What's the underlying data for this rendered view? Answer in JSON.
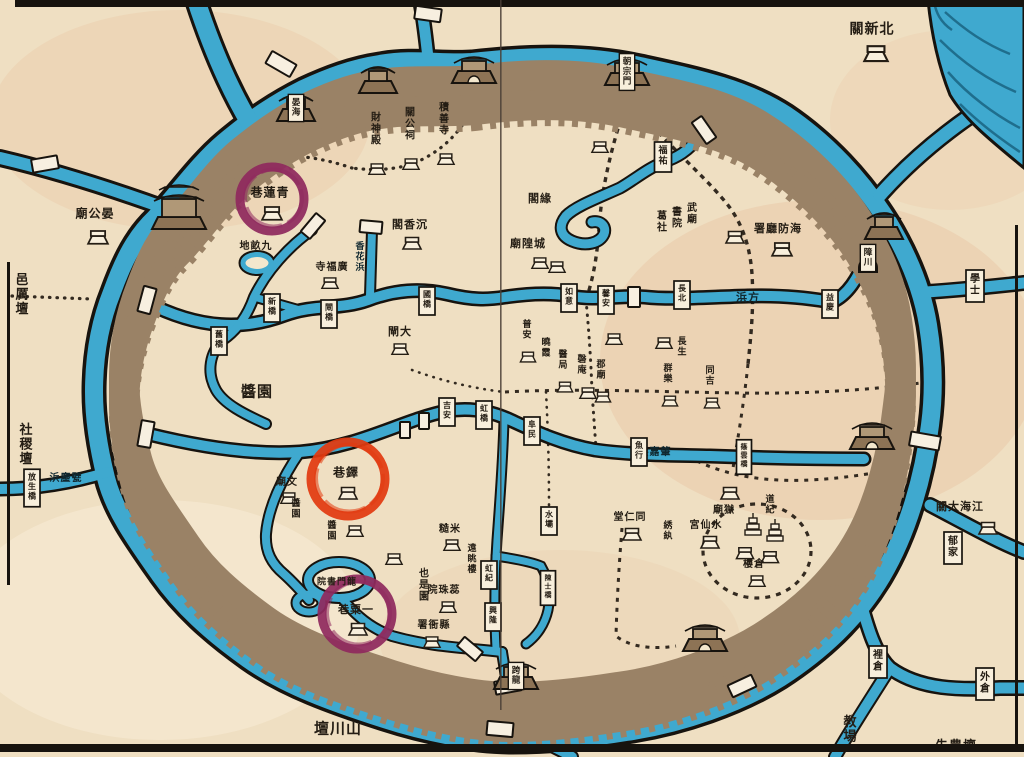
{
  "palette": {
    "paper": "#efdfc2",
    "paper_light": "#f6ead2",
    "tint_pink": "#e4b28c",
    "water": "#3fa9cf",
    "water_dark": "#2383a8",
    "ink": "#241d14",
    "wall": "#9b capitalize",
    "wall_band": "#9a8266",
    "wall_line": "#64503a",
    "box_fill": "#f8efdc",
    "purple": "#8f2a5e",
    "red": "#e23a10"
  },
  "annotation_circles": [
    {
      "id": "circle-qinglian",
      "cx": 272,
      "cy": 199,
      "r": 32,
      "color": "#8f2a5e",
      "label": "青蓮巷"
    },
    {
      "id": "circle-duo",
      "cx": 348,
      "cy": 479,
      "r": 37,
      "color": "#e23a10",
      "label": "鐸巷"
    },
    {
      "id": "circle-yisu",
      "cx": 357,
      "cy": 614,
      "r": 35,
      "color": "#8f2a5e",
      "label": "一粟巷"
    }
  ],
  "labels": [
    {
      "t": "關新北",
      "x": 872,
      "y": 28,
      "o": "h",
      "s": 14,
      "house": {
        "x": 876,
        "y": 52,
        "k": 1.3
      }
    },
    {
      "t": "廟公晏",
      "x": 95,
      "y": 213,
      "o": "h",
      "s": 12,
      "house": {
        "x": 98,
        "y": 236,
        "k": 1.1
      }
    },
    {
      "t": "邑厲壇",
      "x": 22,
      "y": 295,
      "o": "v",
      "s": 13
    },
    {
      "t": "社稷壇",
      "x": 26,
      "y": 445,
      "o": "v",
      "s": 13
    },
    {
      "t": "壇川山",
      "x": 338,
      "y": 728,
      "o": "h",
      "s": 15
    },
    {
      "t": "教場",
      "x": 850,
      "y": 730,
      "o": "v",
      "s": 13
    },
    {
      "t": "先農壇",
      "x": 956,
      "y": 745,
      "o": "h",
      "s": 13
    },
    {
      "t": "署廳防海",
      "x": 778,
      "y": 228,
      "o": "h",
      "s": 11,
      "house": {
        "x": 782,
        "y": 248,
        "k": 1.1
      }
    },
    {
      "t": "浜方",
      "x": 748,
      "y": 297,
      "o": "h",
      "s": 11,
      "cls": "oncanal"
    },
    {
      "t": "浜嘉肇",
      "x": 655,
      "y": 451,
      "o": "h",
      "s": 10,
      "cls": "oncanal"
    },
    {
      "t": "浜麈甓",
      "x": 66,
      "y": 477,
      "o": "h",
      "s": 10,
      "cls": "oncanal"
    },
    {
      "t": "學士",
      "x": 975,
      "y": 286,
      "o": "v",
      "s": 10,
      "box": true
    },
    {
      "t": "郁家",
      "x": 953,
      "y": 548,
      "o": "v",
      "s": 10,
      "box": true
    },
    {
      "t": "裡倉",
      "x": 878,
      "y": 662,
      "o": "v",
      "s": 10,
      "box": true
    },
    {
      "t": "外倉",
      "x": 985,
      "y": 684,
      "o": "v",
      "s": 10,
      "box": true
    },
    {
      "t": "關大海江",
      "x": 960,
      "y": 506,
      "o": "h",
      "s": 11,
      "house": {
        "x": 988,
        "y": 527,
        "k": 1
      }
    },
    {
      "t": "放生橋",
      "x": 32,
      "y": 488,
      "o": "v",
      "s": 8,
      "box": true
    },
    {
      "t": "巷蓮青",
      "x": 270,
      "y": 192,
      "o": "h",
      "s": 12,
      "house": {
        "x": 272,
        "y": 212,
        "k": 1.1
      }
    },
    {
      "t": "地畝九",
      "x": 256,
      "y": 245,
      "o": "h",
      "s": 10
    },
    {
      "t": "寺福廣",
      "x": 332,
      "y": 266,
      "o": "h",
      "s": 10,
      "house": {
        "x": 330,
        "y": 282,
        "k": 0.9
      }
    },
    {
      "t": "香花浜",
      "x": 360,
      "y": 258,
      "o": "v",
      "s": 9,
      "cls": "oncanal"
    },
    {
      "t": "財神殿",
      "x": 376,
      "y": 130,
      "o": "v",
      "s": 10,
      "house": {
        "x": 377,
        "y": 168,
        "k": 0.9
      }
    },
    {
      "t": "關公祠",
      "x": 410,
      "y": 125,
      "o": "v",
      "s": 10,
      "house": {
        "x": 411,
        "y": 163,
        "k": 0.9
      }
    },
    {
      "t": "積善寺",
      "x": 444,
      "y": 120,
      "o": "v",
      "s": 10,
      "house": {
        "x": 446,
        "y": 158,
        "k": 0.9
      }
    },
    {
      "t": "閣香沉",
      "x": 410,
      "y": 224,
      "o": "h",
      "s": 11,
      "house": {
        "x": 412,
        "y": 242,
        "k": 1
      }
    },
    {
      "t": "閣緣",
      "x": 540,
      "y": 198,
      "o": "h",
      "s": 11
    },
    {
      "t": "福祐",
      "x": 663,
      "y": 157,
      "o": "v",
      "s": 9,
      "box": true
    },
    {
      "t": "武廟",
      "x": 692,
      "y": 215,
      "o": "v",
      "s": 10
    },
    {
      "t": "書院",
      "x": 677,
      "y": 219,
      "o": "v",
      "s": 10
    },
    {
      "t": "葛社",
      "x": 662,
      "y": 223,
      "o": "v",
      "s": 10
    },
    {
      "t": "廟隍城",
      "x": 528,
      "y": 243,
      "o": "h",
      "s": 11
    },
    {
      "t": "閘大",
      "x": 400,
      "y": 331,
      "o": "h",
      "s": 11,
      "house": {
        "x": 400,
        "y": 348,
        "k": 0.9
      }
    },
    {
      "t": "新橋",
      "x": 272,
      "y": 308,
      "o": "v",
      "s": 8,
      "box": true
    },
    {
      "t": "閘橋",
      "x": 329,
      "y": 314,
      "o": "v",
      "s": 8,
      "box": true
    },
    {
      "t": "國橋",
      "x": 427,
      "y": 301,
      "o": "v",
      "s": 8,
      "box": true
    },
    {
      "t": "如意",
      "x": 569,
      "y": 298,
      "o": "v",
      "s": 8,
      "box": true
    },
    {
      "t": "馨安",
      "x": 606,
      "y": 300,
      "o": "v",
      "s": 8,
      "box": true
    },
    {
      "t": "長北",
      "x": 682,
      "y": 295,
      "o": "v",
      "s": 8,
      "box": true
    },
    {
      "t": "益慶",
      "x": 830,
      "y": 304,
      "o": "v",
      "s": 8,
      "box": true
    },
    {
      "t": "舊橋",
      "x": 219,
      "y": 341,
      "o": "v",
      "s": 8,
      "box": true
    },
    {
      "t": "吉安",
      "x": 447,
      "y": 412,
      "o": "v",
      "s": 8,
      "box": true
    },
    {
      "t": "虹橋",
      "x": 484,
      "y": 415,
      "o": "v",
      "s": 8,
      "box": true
    },
    {
      "t": "阜民",
      "x": 532,
      "y": 431,
      "o": "v",
      "s": 8,
      "box": true
    },
    {
      "t": "魚行",
      "x": 639,
      "y": 452,
      "o": "v",
      "s": 8,
      "box": true
    },
    {
      "t": "篠雲橋",
      "x": 744,
      "y": 457,
      "o": "v",
      "s": 7,
      "box": true
    },
    {
      "t": "水壩",
      "x": 549,
      "y": 521,
      "o": "v",
      "s": 8,
      "box": true
    },
    {
      "t": "虹紀",
      "x": 489,
      "y": 575,
      "o": "v",
      "s": 8,
      "box": true
    },
    {
      "t": "興隆",
      "x": 493,
      "y": 617,
      "o": "v",
      "s": 8,
      "box": true
    },
    {
      "t": "陳士橋",
      "x": 548,
      "y": 588,
      "o": "v",
      "s": 7,
      "box": true
    },
    {
      "t": "醬園",
      "x": 257,
      "y": 391,
      "o": "h",
      "s": 15
    },
    {
      "t": "廟文",
      "x": 287,
      "y": 481,
      "o": "h",
      "s": 10,
      "house": {
        "x": 289,
        "y": 497,
        "k": 0.9
      }
    },
    {
      "t": "醬園",
      "x": 296,
      "y": 510,
      "o": "v",
      "s": 9
    },
    {
      "t": "巷鐸",
      "x": 346,
      "y": 472,
      "o": "h",
      "s": 12,
      "house": {
        "x": 348,
        "y": 492,
        "k": 1
      }
    },
    {
      "t": "醬園",
      "x": 332,
      "y": 532,
      "o": "v",
      "s": 9
    },
    {
      "t": "遠眺樓",
      "x": 472,
      "y": 560,
      "o": "v",
      "s": 9
    },
    {
      "t": "糙米",
      "x": 450,
      "y": 528,
      "o": "h",
      "s": 10,
      "house": {
        "x": 452,
        "y": 544,
        "k": 0.9
      }
    },
    {
      "t": "院珠蕊",
      "x": 444,
      "y": 589,
      "o": "h",
      "s": 10,
      "house": {
        "x": 448,
        "y": 606,
        "k": 0.9
      }
    },
    {
      "t": "也是園",
      "x": 424,
      "y": 586,
      "o": "v",
      "s": 10
    },
    {
      "t": "署衙縣",
      "x": 434,
      "y": 624,
      "o": "h",
      "s": 10,
      "house": {
        "x": 432,
        "y": 641,
        "k": 0.9
      }
    },
    {
      "t": "院書門龍",
      "x": 337,
      "y": 581,
      "o": "h",
      "s": 9
    },
    {
      "t": "巷粟一",
      "x": 356,
      "y": 609,
      "o": "h",
      "s": 11,
      "house": {
        "x": 358,
        "y": 628,
        "k": 1
      }
    },
    {
      "t": "堂仁同",
      "x": 630,
      "y": 516,
      "o": "h",
      "s": 10,
      "house": {
        "x": 632,
        "y": 533,
        "k": 1
      }
    },
    {
      "t": "綉紈",
      "x": 668,
      "y": 532,
      "o": "v",
      "s": 9
    },
    {
      "t": "廟獄",
      "x": 724,
      "y": 509,
      "o": "h",
      "s": 10,
      "house": {
        "x": 730,
        "y": 492,
        "k": 1
      }
    },
    {
      "t": "宮仙水",
      "x": 706,
      "y": 524,
      "o": "h",
      "s": 10,
      "house": {
        "x": 710,
        "y": 541,
        "k": 1
      }
    },
    {
      "t": "道紀",
      "x": 770,
      "y": 506,
      "o": "v",
      "s": 9
    },
    {
      "t": "樓倉",
      "x": 754,
      "y": 563,
      "o": "h",
      "s": 10,
      "house": {
        "x": 757,
        "y": 580,
        "k": 0.9
      }
    },
    {
      "t": "普安",
      "x": 527,
      "y": 331,
      "o": "v",
      "s": 9,
      "house": {
        "x": 528,
        "y": 356,
        "k": 0.85
      }
    },
    {
      "t": "曉霞",
      "x": 546,
      "y": 349,
      "o": "v",
      "s": 9
    },
    {
      "t": "醫局",
      "x": 563,
      "y": 361,
      "o": "v",
      "s": 9,
      "house": {
        "x": 565,
        "y": 386,
        "k": 0.85
      }
    },
    {
      "t": "磬庵",
      "x": 582,
      "y": 366,
      "o": "v",
      "s": 9
    },
    {
      "t": "郡廟",
      "x": 601,
      "y": 371,
      "o": "v",
      "s": 9,
      "house": {
        "x": 603,
        "y": 396,
        "k": 0.85
      }
    },
    {
      "t": "群樂",
      "x": 668,
      "y": 375,
      "o": "v",
      "s": 9,
      "house": {
        "x": 670,
        "y": 400,
        "k": 0.85
      }
    },
    {
      "t": "同吉",
      "x": 710,
      "y": 377,
      "o": "v",
      "s": 9,
      "house": {
        "x": 712,
        "y": 402,
        "k": 0.85
      }
    },
    {
      "t": "長生",
      "x": 682,
      "y": 348,
      "o": "v",
      "s": 9
    }
  ],
  "towers": [
    {
      "x": 179,
      "y": 212,
      "type": "big"
    },
    {
      "x": 296,
      "y": 108,
      "type": "tower",
      "label": "晏海"
    },
    {
      "x": 378,
      "y": 80,
      "type": "tower"
    },
    {
      "x": 474,
      "y": 70,
      "type": "gate"
    },
    {
      "x": 627,
      "y": 72,
      "type": "gate",
      "label": "朝宗門"
    },
    {
      "x": 884,
      "y": 226,
      "type": "tower"
    },
    {
      "x": 872,
      "y": 436,
      "type": "gate"
    },
    {
      "x": 705,
      "y": 638,
      "type": "gate"
    },
    {
      "x": 516,
      "y": 676,
      "type": "gate",
      "label": "跨龍"
    },
    {
      "x": 868,
      "y": 258,
      "type": "watergate",
      "label": "障川"
    }
  ],
  "bridges": [
    {
      "x": 45,
      "y": 164,
      "a": -10,
      "w": 26,
      "h": 13
    },
    {
      "x": 281,
      "y": 64,
      "a": 30,
      "w": 28,
      "h": 14
    },
    {
      "x": 428,
      "y": 14,
      "a": 8,
      "w": 26,
      "h": 13
    },
    {
      "x": 147,
      "y": 300,
      "a": 15,
      "w": 13,
      "h": 26
    },
    {
      "x": 146,
      "y": 434,
      "a": 10,
      "w": 13,
      "h": 26
    },
    {
      "x": 313,
      "y": 226,
      "a": 40,
      "w": 12,
      "h": 24
    },
    {
      "x": 371,
      "y": 227,
      "a": 5,
      "w": 22,
      "h": 12
    },
    {
      "x": 704,
      "y": 130,
      "a": -35,
      "w": 12,
      "h": 26
    },
    {
      "x": 925,
      "y": 441,
      "a": 10,
      "w": 30,
      "h": 14
    },
    {
      "x": 742,
      "y": 686,
      "a": -25,
      "w": 26,
      "h": 13
    },
    {
      "x": 500,
      "y": 729,
      "a": 5,
      "w": 26,
      "h": 14
    },
    {
      "x": 470,
      "y": 649,
      "a": 40,
      "w": 24,
      "h": 12
    },
    {
      "x": 508,
      "y": 686,
      "a": 80,
      "w": 13,
      "h": 26
    },
    {
      "x": 405,
      "y": 430,
      "a": 0,
      "w": 10,
      "h": 16
    },
    {
      "x": 424,
      "y": 421,
      "a": 0,
      "w": 10,
      "h": 16
    },
    {
      "x": 634,
      "y": 297,
      "a": 0,
      "w": 12,
      "h": 20
    }
  ],
  "extra_houses": [
    {
      "x": 540,
      "y": 262,
      "k": 0.9
    },
    {
      "x": 557,
      "y": 266,
      "k": 0.9
    },
    {
      "x": 614,
      "y": 338,
      "k": 0.9
    },
    {
      "x": 664,
      "y": 342,
      "k": 0.9
    },
    {
      "x": 588,
      "y": 392,
      "k": 0.9
    },
    {
      "x": 355,
      "y": 530,
      "k": 0.9
    },
    {
      "x": 394,
      "y": 558,
      "k": 0.9
    },
    {
      "x": 745,
      "y": 552,
      "k": 0.95
    },
    {
      "x": 770,
      "y": 556,
      "k": 0.95
    },
    {
      "x": 600,
      "y": 146,
      "k": 0.9
    },
    {
      "x": 735,
      "y": 236,
      "k": 1.0
    },
    {
      "x": 97,
      "y": 236,
      "k": 0
    }
  ],
  "pagodas": [
    {
      "x": 753,
      "y": 524
    },
    {
      "x": 775,
      "y": 530
    }
  ]
}
